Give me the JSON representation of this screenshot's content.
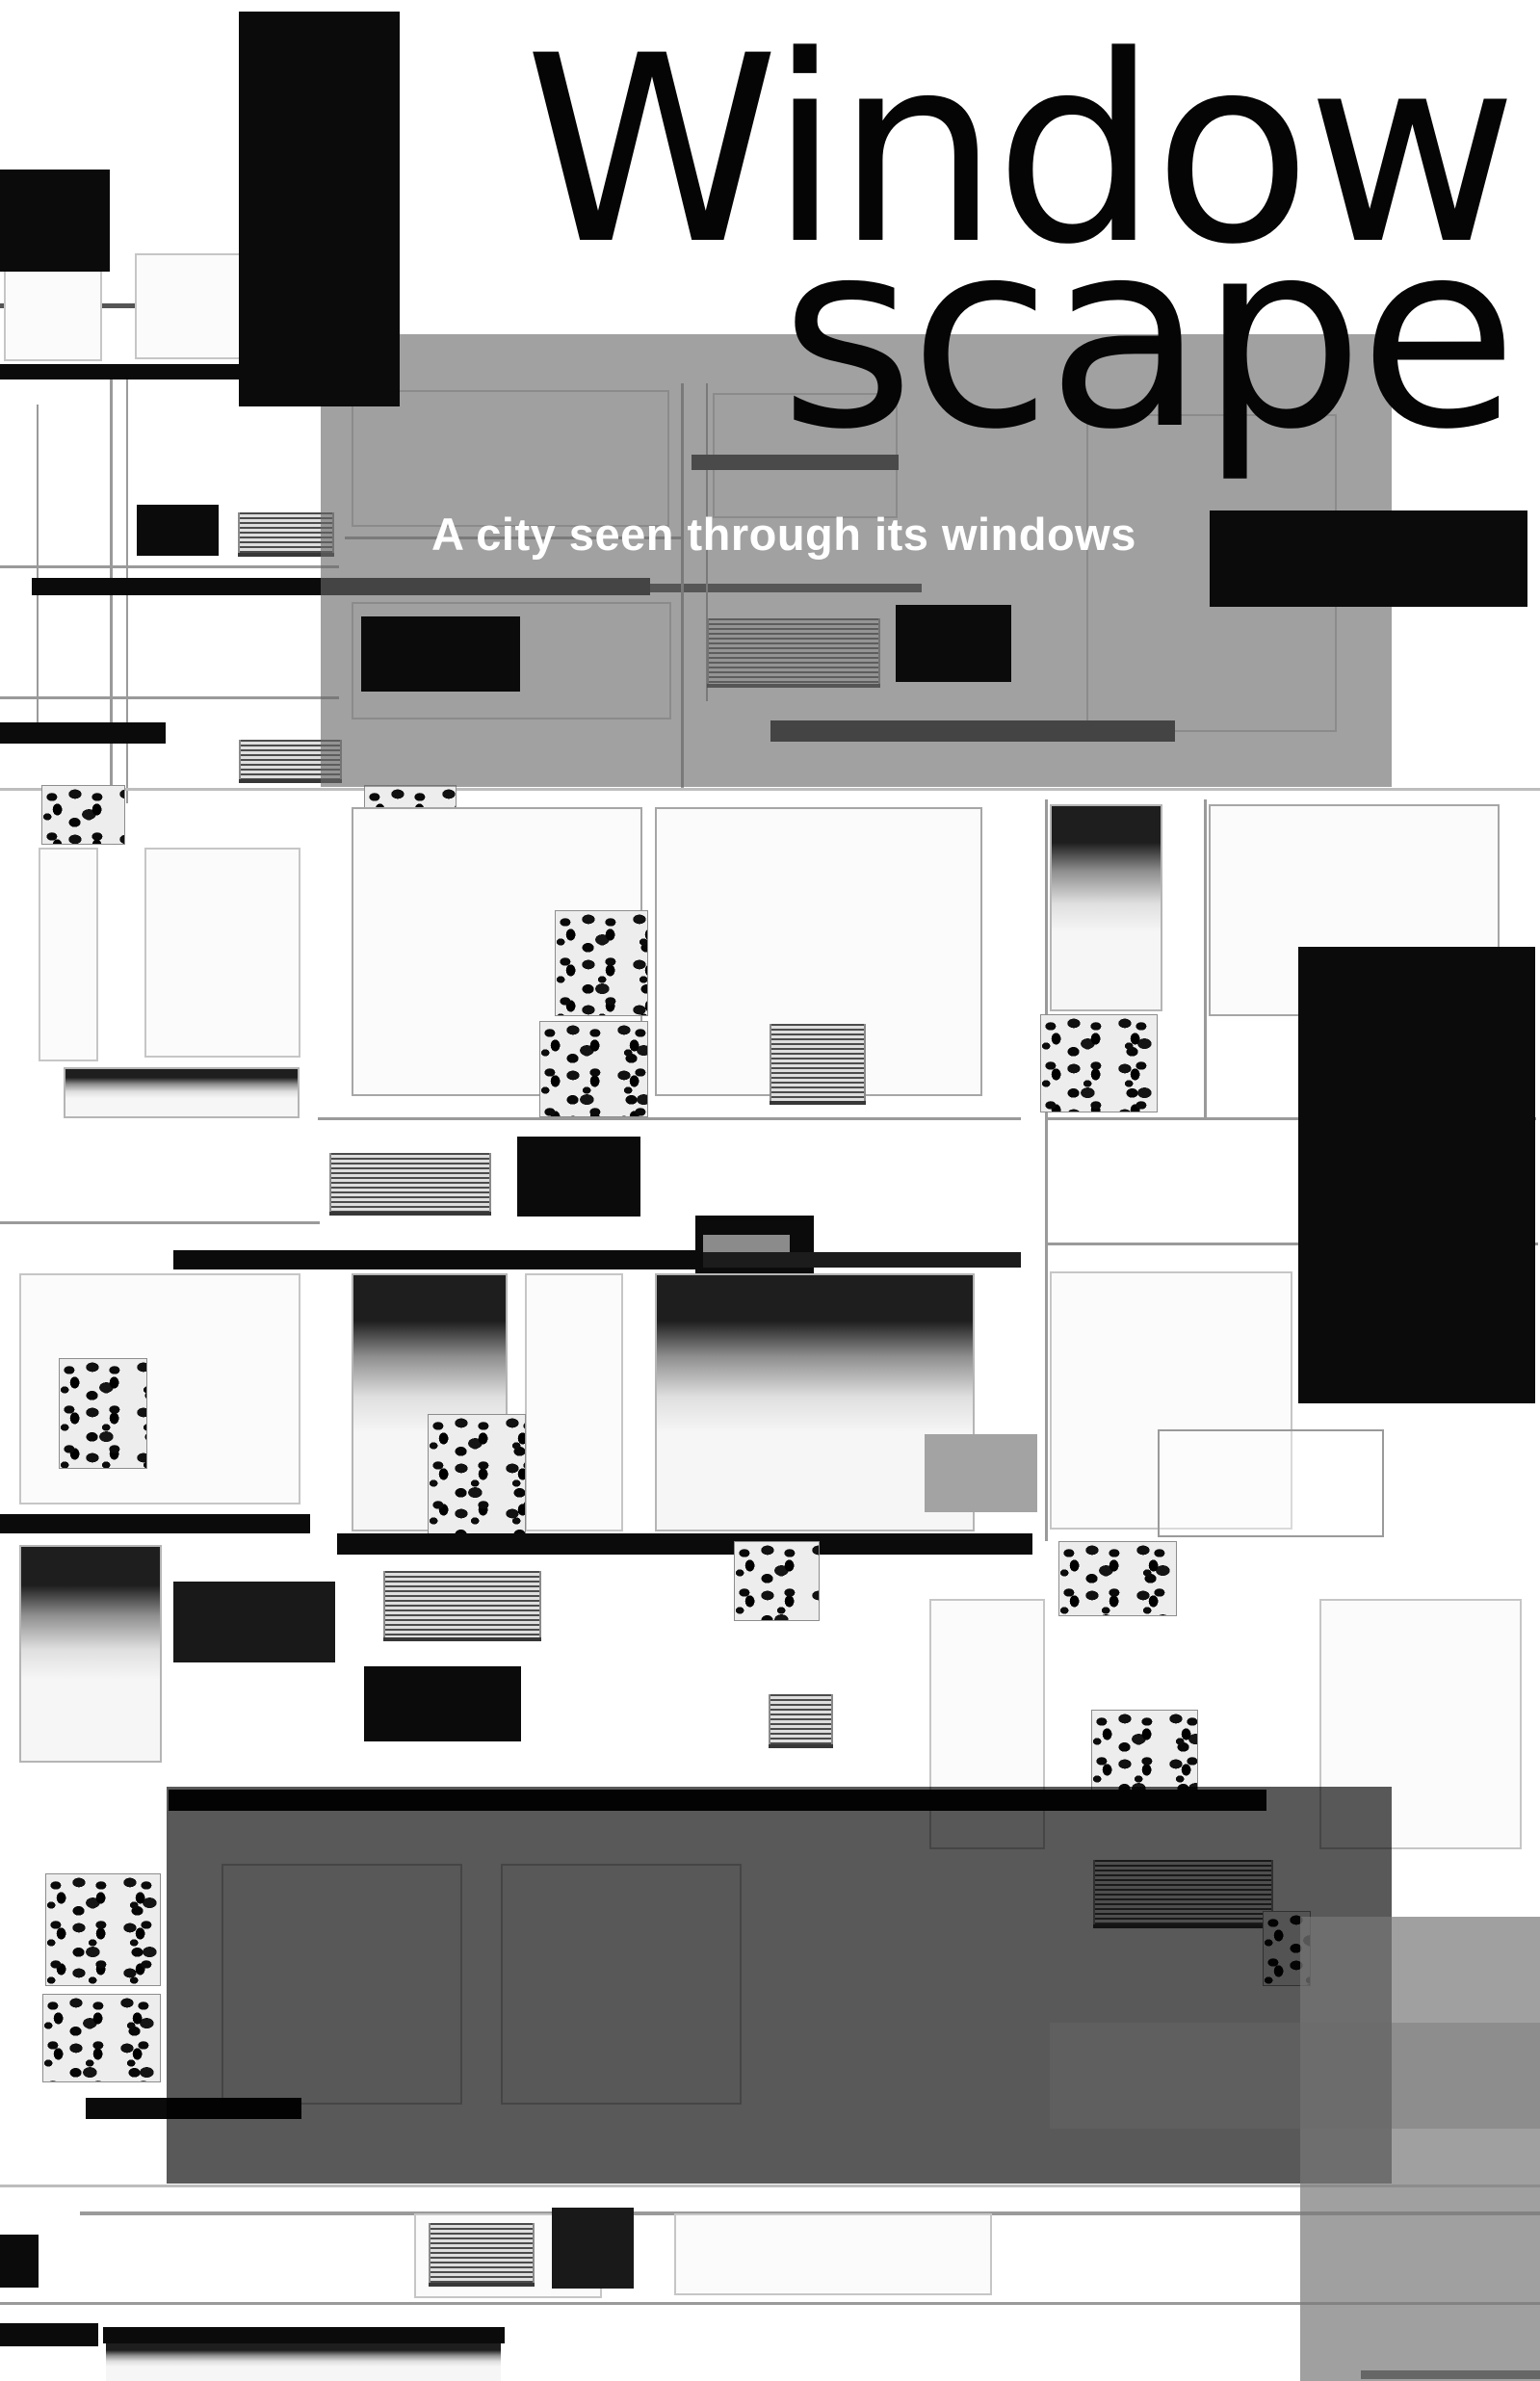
{
  "poster": {
    "title_line1": "Window",
    "title_line2": "scape",
    "subtitle": "A city seen through its windows"
  },
  "palette": {
    "paper": "#ffffff",
    "ink": "#0b0b0b",
    "title_ink": "#050505",
    "subtitle_text": "#ffffff",
    "frame_line": "#9a9a9a",
    "top_overlay": "rgba(104,104,104,0.62)",
    "dark_overlay": "rgba(0,0,0,0.65)",
    "bottom_right_overlay": "rgba(120,120,120,0.70)",
    "gray_band": "rgba(105,105,105,0.35)",
    "solid_gray_block": "#a3a3a3"
  }
}
